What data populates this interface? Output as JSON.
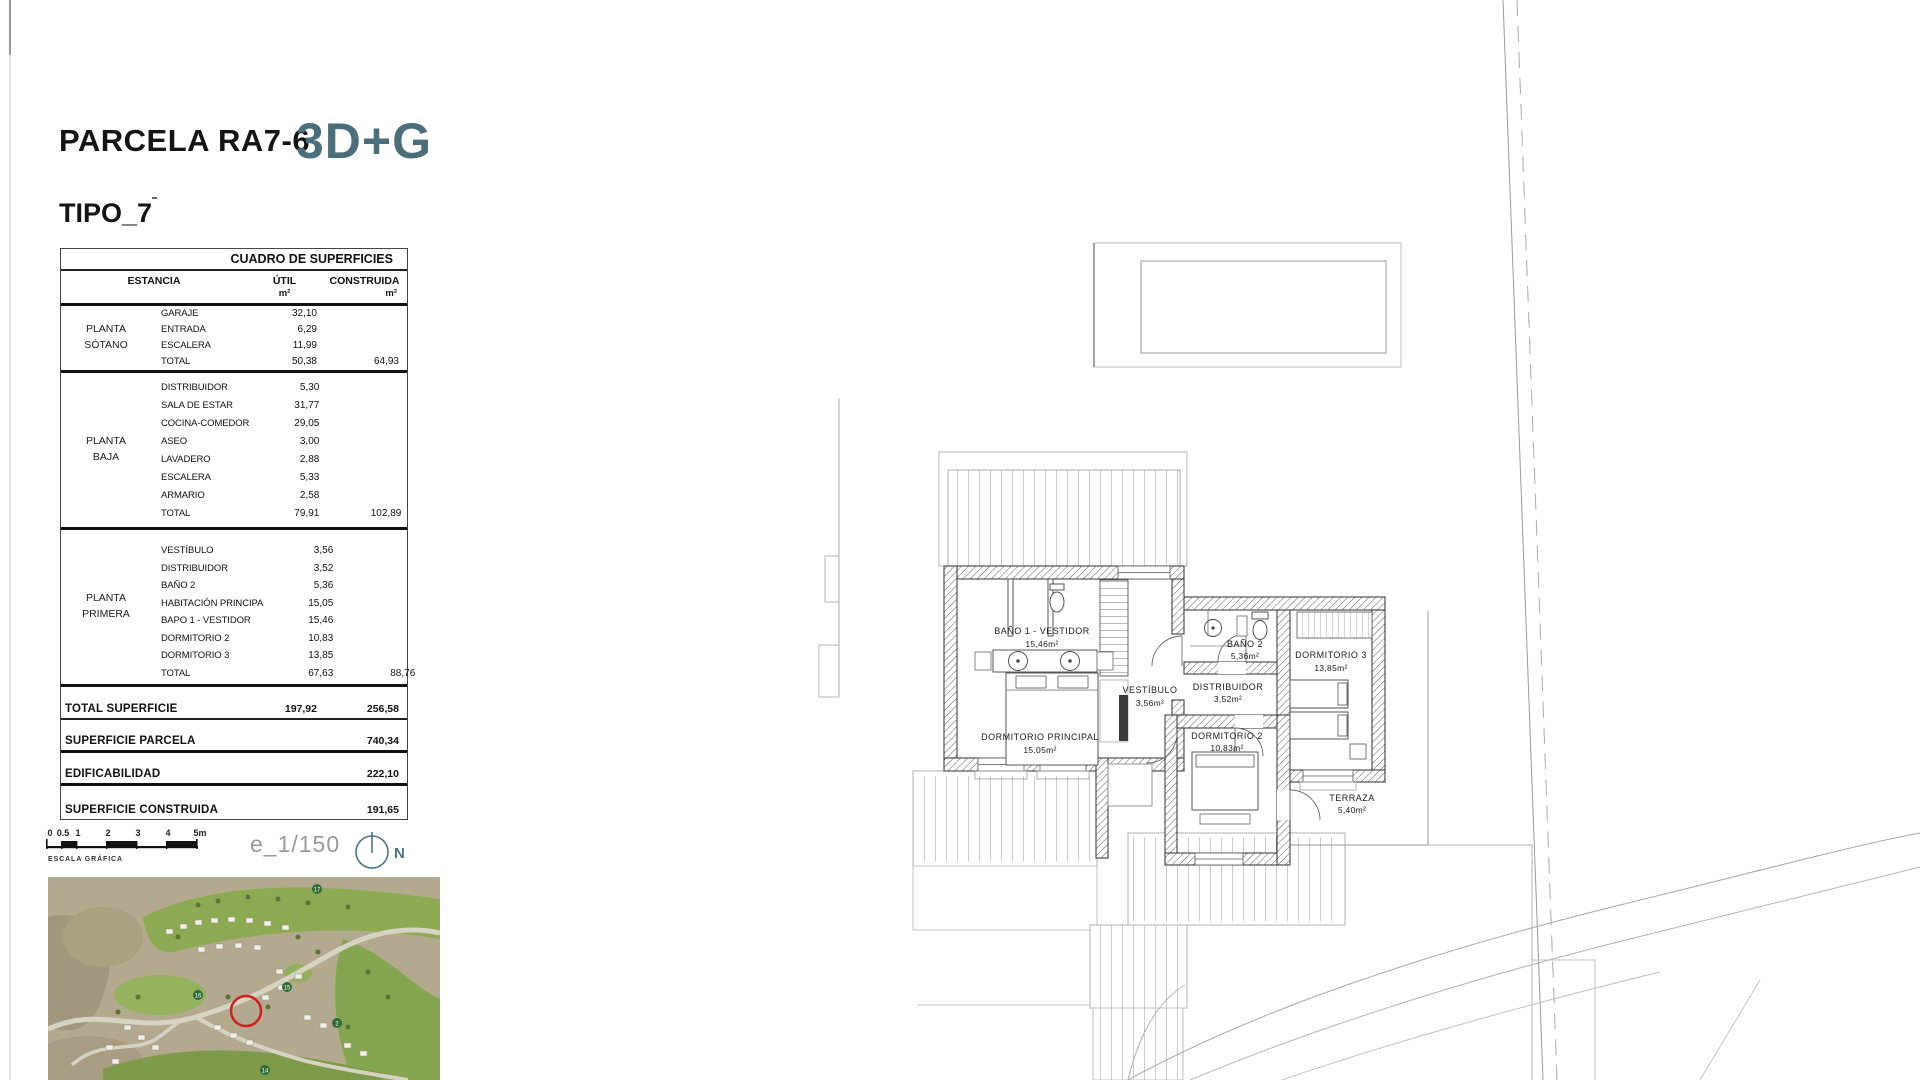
{
  "header": {
    "parcel_title": "PARCELA RA7-6",
    "model_code": "3D+G",
    "type_label": "TIPO_7"
  },
  "colors": {
    "accent_teal": "#4a6f7a",
    "marker_red": "#d01f1f",
    "wall_dark": "#2f2f2f",
    "site_line_gray": "#b0b0b0"
  },
  "surface_table": {
    "title": "CUADRO DE SUPERFICIES",
    "columns": {
      "estancia": "ESTANCIA",
      "util": "ÚTIL",
      "construida": "CONSTRUIDA",
      "unit_util": "m²",
      "unit_construida": "m²"
    },
    "sections": [
      {
        "group_line1": "PLANTA",
        "group_line2": "SÓTANO",
        "rows": [
          {
            "name": "GARAJE",
            "util": "32,10"
          },
          {
            "name": "ENTRADA",
            "util": "6,29"
          },
          {
            "name": "ESCALERA",
            "util": "11,99"
          }
        ],
        "total": {
          "name": "TOTAL",
          "util": "50,38",
          "construida": "64,93"
        }
      },
      {
        "group_line1": "PLANTA",
        "group_line2": "BAJA",
        "rows": [
          {
            "name": "DISTRIBUIDOR",
            "util": "5,30"
          },
          {
            "name": "SALA DE ESTAR",
            "util": "31,77"
          },
          {
            "name": "COCINA-COMEDOR",
            "util": "29,05"
          },
          {
            "name": "ASEO",
            "util": "3,00"
          },
          {
            "name": "LAVADERO",
            "util": "2,88"
          },
          {
            "name": "ESCALERA",
            "util": "5,33"
          },
          {
            "name": "ARMARIO",
            "util": "2,58"
          }
        ],
        "total": {
          "name": "TOTAL",
          "util": "79,91",
          "construida": "102,89"
        }
      },
      {
        "group_line1": "PLANTA",
        "group_line2": "PRIMERA",
        "rows": [
          {
            "name": "VESTÍBULO",
            "util": "3,56"
          },
          {
            "name": "DISTRIBUIDOR",
            "util": "3,52"
          },
          {
            "name": "BAÑO 2",
            "util": "5,36"
          },
          {
            "name": "HABITACIÓN PRINCIPA",
            "util": "15,05"
          },
          {
            "name": "BAPO 1 - VESTIDOR",
            "util": "15,46"
          },
          {
            "name": "DORMITORIO 2",
            "util": "10,83"
          },
          {
            "name": "DORMITORIO 3",
            "util": "13,85"
          }
        ],
        "total": {
          "name": "TOTAL",
          "util": "67,63",
          "construida": "88,76"
        }
      }
    ],
    "summary": [
      {
        "label": "TOTAL SUPERFICIE",
        "util": "197,92",
        "construida": "256,58"
      },
      {
        "label": "SUPERFICIE PARCELA",
        "util": "",
        "construida": "740,34"
      },
      {
        "label": "EDIFICABILIDAD",
        "util": "",
        "construida": "222,10"
      },
      {
        "label": "SUPERFICIE CONSTRUIDA",
        "util": "",
        "construida": "191,65"
      }
    ]
  },
  "scale_bar": {
    "ticks": [
      "0",
      "0.5",
      "1",
      "2",
      "3",
      "4",
      "5m"
    ],
    "caption": "ESCALA GRÁFICA",
    "scale_text": "e_1/150",
    "north_label": "N"
  },
  "floor_plan": {
    "rooms": [
      {
        "name": "BAÑO 1 - VESTIDOR",
        "area": "15,46m²"
      },
      {
        "name": "DORMITORIO PRINCIPAL",
        "area": "15,05m²"
      },
      {
        "name": "VESTÍBULO",
        "area": "3,56m²"
      },
      {
        "name": "BAÑO 2",
        "area": "5,36m²"
      },
      {
        "name": "DISTRIBUIDOR",
        "area": "3,52m²"
      },
      {
        "name": "DORMITORIO 3",
        "area": "13,85m²"
      },
      {
        "name": "DORMITORIO 2",
        "area": "10,83m²"
      },
      {
        "name": "TERRAZA",
        "area": "5,40m²"
      }
    ]
  },
  "site_map": {
    "hole_markers": [
      "17",
      "16",
      "15",
      "2",
      "14"
    ]
  }
}
